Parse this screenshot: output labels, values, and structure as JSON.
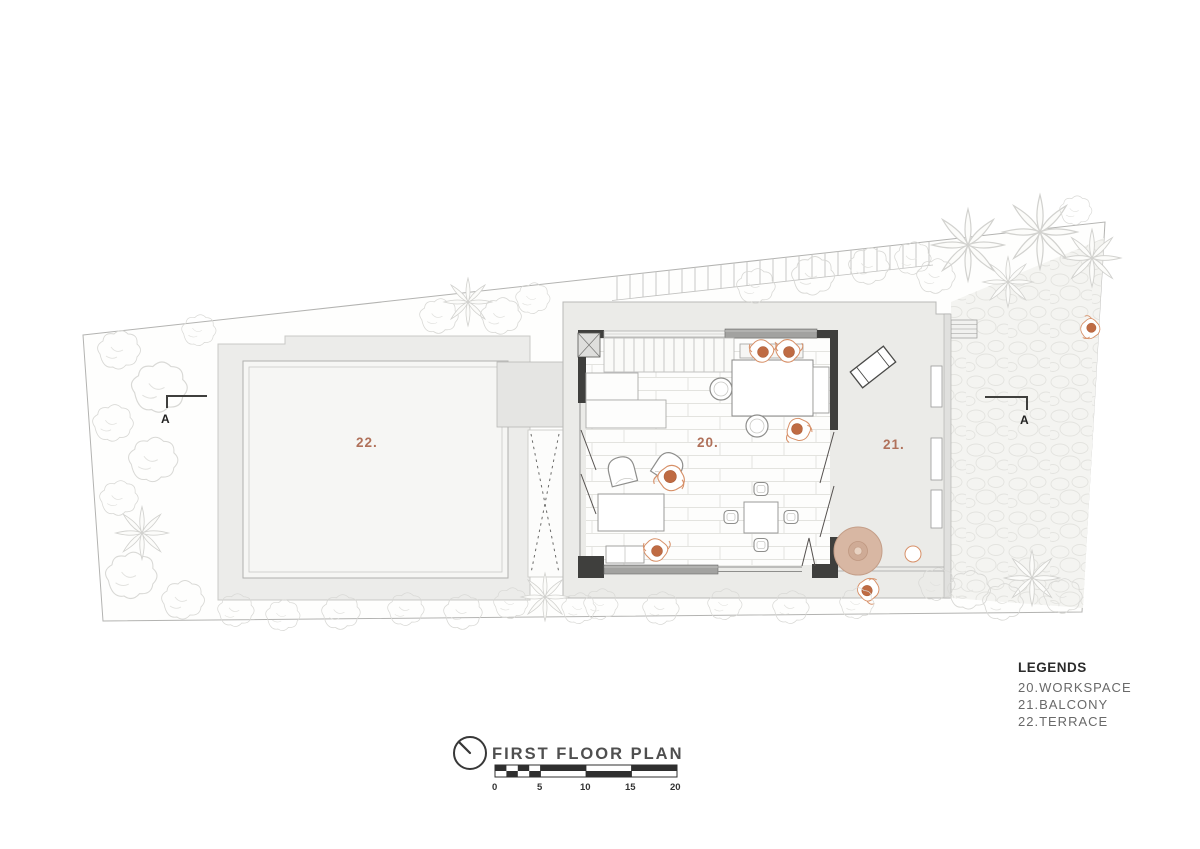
{
  "plan": {
    "title": "FIRST FLOOR PLAN",
    "section_marker": "A",
    "labels": {
      "workspace": "20.",
      "balcony": "21.",
      "terrace": "22."
    },
    "legend": {
      "heading": "LEGENDS",
      "items": [
        "20.WORKSPACE",
        "21.BALCONY",
        "22.TERRACE"
      ]
    },
    "scale": {
      "ticks": [
        "0",
        "5",
        "10",
        "15",
        "20"
      ]
    },
    "colors": {
      "accent": "#b0715a",
      "wall": "#3f3f3d",
      "window_band": "#a2a2a0",
      "person_head": "#bf6b43",
      "table_tan": "#d8b7a3"
    }
  }
}
